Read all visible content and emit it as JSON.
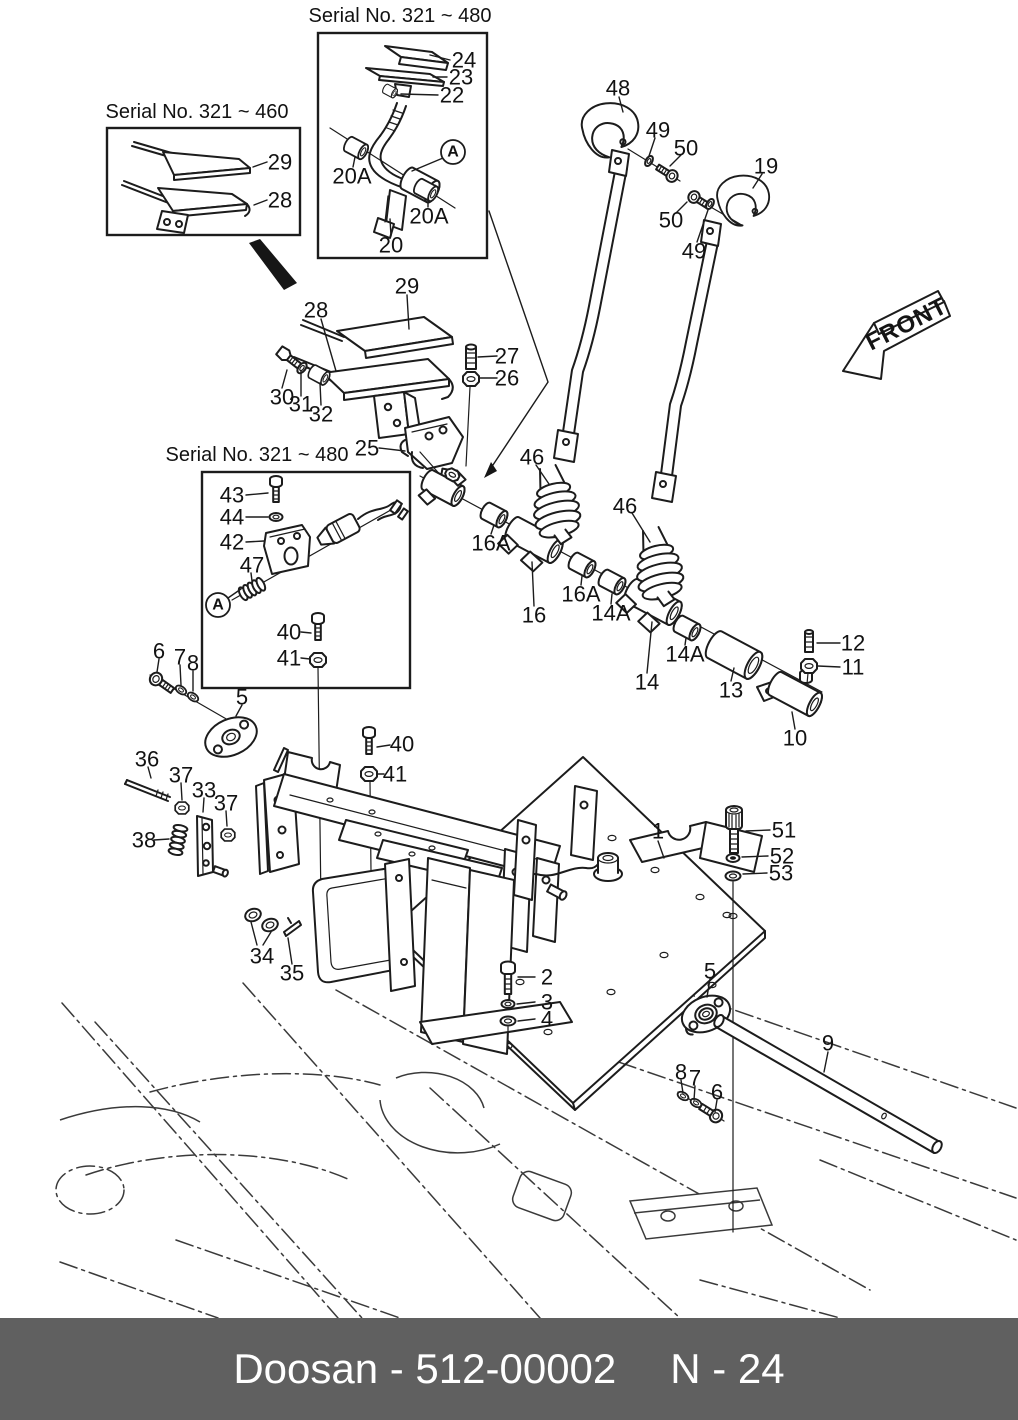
{
  "insets": [
    {
      "label": "Serial No. 321 ~ 460"
    },
    {
      "label": "Serial No. 321 ~ 480"
    },
    {
      "label": "Serial No. 321 ~ 480"
    }
  ],
  "front_arrow": {
    "label": "FRONT"
  },
  "markers": [
    {
      "label": "A",
      "x": 453,
      "y": 152,
      "leader": [
        443,
        158,
        412,
        171
      ]
    },
    {
      "label": "A",
      "x": 218,
      "y": 605,
      "leader": [
        228,
        598,
        241,
        589
      ]
    }
  ],
  "callouts": [
    {
      "label": "29",
      "x": 280,
      "y": 162,
      "leader": [
        267,
        162,
        253,
        167
      ]
    },
    {
      "label": "28",
      "x": 280,
      "y": 200,
      "leader": [
        267,
        200,
        254,
        205
      ]
    },
    {
      "label": "24",
      "x": 464,
      "y": 60,
      "leader": [
        450,
        60,
        430,
        55
      ]
    },
    {
      "label": "23",
      "x": 461,
      "y": 77,
      "leader": [
        447,
        77,
        433,
        77
      ]
    },
    {
      "label": "22",
      "x": 452,
      "y": 95,
      "leader": [
        438,
        95,
        401,
        94
      ]
    },
    {
      "label": "20A",
      "x": 352,
      "y": 176,
      "leader": [
        353,
        167,
        355,
        157
      ]
    },
    {
      "label": "20A",
      "x": 429,
      "y": 216,
      "leader": [
        428,
        207,
        428,
        198
      ]
    },
    {
      "label": "20",
      "x": 391,
      "y": 245,
      "leader": [
        391,
        236,
        390,
        219
      ]
    },
    {
      "label": "48",
      "x": 618,
      "y": 88,
      "leader": [
        619,
        97,
        623,
        112
      ]
    },
    {
      "label": "49",
      "x": 658,
      "y": 130,
      "leader": [
        655,
        138,
        649,
        156
      ]
    },
    {
      "label": "50",
      "x": 686,
      "y": 148,
      "leader": [
        681,
        155,
        670,
        166
      ]
    },
    {
      "label": "19",
      "x": 766,
      "y": 166,
      "leader": [
        762,
        174,
        753,
        188
      ]
    },
    {
      "label": "50",
      "x": 671,
      "y": 220,
      "leader": [
        676,
        213,
        687,
        202
      ]
    },
    {
      "label": "49",
      "x": 694,
      "y": 251,
      "leader": [
        697,
        242,
        708,
        210
      ]
    },
    {
      "label": "29",
      "x": 407,
      "y": 286,
      "leader": [
        407,
        295,
        409,
        329
      ]
    },
    {
      "label": "28",
      "x": 316,
      "y": 310,
      "leader": [
        321,
        319,
        336,
        371
      ]
    },
    {
      "label": "27",
      "x": 507,
      "y": 356,
      "leader": [
        497,
        356,
        478,
        357
      ]
    },
    {
      "label": "26",
      "x": 507,
      "y": 378,
      "leader": [
        497,
        378,
        480,
        378
      ]
    },
    {
      "label": "30",
      "x": 282,
      "y": 397,
      "leader": [
        282,
        388,
        287,
        370
      ]
    },
    {
      "label": "31",
      "x": 301,
      "y": 404,
      "leader": [
        301,
        396,
        301,
        371
      ]
    },
    {
      "label": "32",
      "x": 321,
      "y": 414,
      "leader": [
        321,
        405,
        320,
        383
      ]
    },
    {
      "label": "25",
      "x": 367,
      "y": 448,
      "leader": [
        379,
        448,
        405,
        451
      ]
    },
    {
      "label": "46",
      "x": 532,
      "y": 457,
      "leader": [
        536,
        465,
        549,
        484
      ]
    },
    {
      "label": "46",
      "x": 625,
      "y": 506,
      "leader": [
        632,
        513,
        650,
        542
      ]
    },
    {
      "label": "16A",
      "x": 491,
      "y": 543,
      "leader": [
        491,
        534,
        494,
        525
      ]
    },
    {
      "label": "16",
      "x": 534,
      "y": 615,
      "leader": [
        534,
        606,
        532,
        562
      ]
    },
    {
      "label": "16A",
      "x": 581,
      "y": 594,
      "leader": [
        581,
        585,
        582,
        576
      ]
    },
    {
      "label": "14A",
      "x": 611,
      "y": 613,
      "leader": [
        611,
        604,
        612,
        594
      ]
    },
    {
      "label": "14A",
      "x": 685,
      "y": 654,
      "leader": [
        685,
        645,
        686,
        638
      ]
    },
    {
      "label": "14",
      "x": 647,
      "y": 682,
      "leader": [
        647,
        673,
        652,
        622
      ]
    },
    {
      "label": "13",
      "x": 731,
      "y": 690,
      "leader": [
        731,
        681,
        734,
        668
      ]
    },
    {
      "label": "12",
      "x": 853,
      "y": 643,
      "leader": [
        840,
        643,
        817,
        643
      ]
    },
    {
      "label": "11",
      "x": 853,
      "y": 667,
      "leader": [
        840,
        667,
        818,
        666
      ]
    },
    {
      "label": "10",
      "x": 795,
      "y": 738,
      "leader": [
        795,
        729,
        792,
        712
      ]
    },
    {
      "label": "43",
      "x": 232,
      "y": 495,
      "leader": [
        246,
        495,
        268,
        493
      ]
    },
    {
      "label": "44",
      "x": 232,
      "y": 517,
      "leader": [
        246,
        517,
        268,
        517
      ]
    },
    {
      "label": "42",
      "x": 232,
      "y": 542,
      "leader": [
        246,
        542,
        264,
        541
      ]
    },
    {
      "label": "47",
      "x": 252,
      "y": 565,
      "leader": [
        251,
        573,
        252,
        581
      ]
    },
    {
      "label": "40",
      "x": 289,
      "y": 632,
      "leader": [
        301,
        632,
        311,
        633
      ]
    },
    {
      "label": "41",
      "x": 289,
      "y": 658,
      "leader": [
        301,
        658,
        310,
        659
      ]
    },
    {
      "label": "40",
      "x": 402,
      "y": 744,
      "leader": [
        390,
        745,
        377,
        747
      ]
    },
    {
      "label": "41",
      "x": 395,
      "y": 774,
      "leader": [
        384,
        774,
        377,
        774
      ]
    },
    {
      "label": "6",
      "x": 159,
      "y": 651,
      "leader": [
        159,
        659,
        157,
        672
      ]
    },
    {
      "label": "7",
      "x": 180,
      "y": 657,
      "leader": [
        180,
        665,
        181,
        685
      ]
    },
    {
      "label": "8",
      "x": 193,
      "y": 663,
      "leader": [
        193,
        671,
        193,
        691
      ]
    },
    {
      "label": "5",
      "x": 242,
      "y": 697,
      "leader": [
        242,
        705,
        236,
        716
      ]
    },
    {
      "label": "36",
      "x": 147,
      "y": 759,
      "leader": [
        148,
        767,
        151,
        778
      ]
    },
    {
      "label": "37",
      "x": 181,
      "y": 775,
      "leader": [
        181,
        783,
        182,
        800
      ]
    },
    {
      "label": "33",
      "x": 204,
      "y": 790,
      "leader": [
        204,
        798,
        203,
        812
      ]
    },
    {
      "label": "37",
      "x": 226,
      "y": 803,
      "leader": [
        226,
        811,
        227,
        826
      ]
    },
    {
      "label": "38",
      "x": 144,
      "y": 840,
      "leader": [
        154,
        840,
        169,
        839
      ]
    },
    {
      "label": "34",
      "x": 262,
      "y": 956
    },
    {
      "label": "35",
      "x": 292,
      "y": 973,
      "leader": [
        292,
        964,
        288,
        938
      ]
    },
    {
      "label": "1",
      "x": 658,
      "y": 831,
      "leader": [
        658,
        841,
        664,
        858
      ]
    },
    {
      "label": "51",
      "x": 784,
      "y": 830,
      "leader": [
        770,
        830,
        746,
        831
      ]
    },
    {
      "label": "52",
      "x": 782,
      "y": 856,
      "leader": [
        768,
        856,
        742,
        857
      ]
    },
    {
      "label": "53",
      "x": 781,
      "y": 873,
      "leader": [
        767,
        873,
        743,
        874
      ]
    },
    {
      "label": "2",
      "x": 547,
      "y": 977,
      "leader": [
        535,
        977,
        518,
        977
      ]
    },
    {
      "label": "3",
      "x": 547,
      "y": 1002,
      "leader": [
        535,
        1002,
        517,
        1004
      ]
    },
    {
      "label": "4",
      "x": 547,
      "y": 1019,
      "leader": [
        535,
        1019,
        518,
        1021
      ]
    },
    {
      "label": "5",
      "x": 710,
      "y": 971,
      "leader": [
        710,
        979,
        707,
        997
      ]
    },
    {
      "label": "9",
      "x": 828,
      "y": 1043,
      "leader": [
        828,
        1052,
        824,
        1072
      ]
    },
    {
      "label": "8",
      "x": 681,
      "y": 1072,
      "leader": [
        681,
        1080,
        683,
        1093
      ]
    },
    {
      "label": "7",
      "x": 695,
      "y": 1078,
      "leader": [
        695,
        1086,
        694,
        1100
      ]
    },
    {
      "label": "6",
      "x": 717,
      "y": 1092,
      "leader": [
        717,
        1100,
        715,
        1112
      ]
    }
  ],
  "footer": {
    "left": "Doosan - 512-00002",
    "right": "N - 24"
  }
}
